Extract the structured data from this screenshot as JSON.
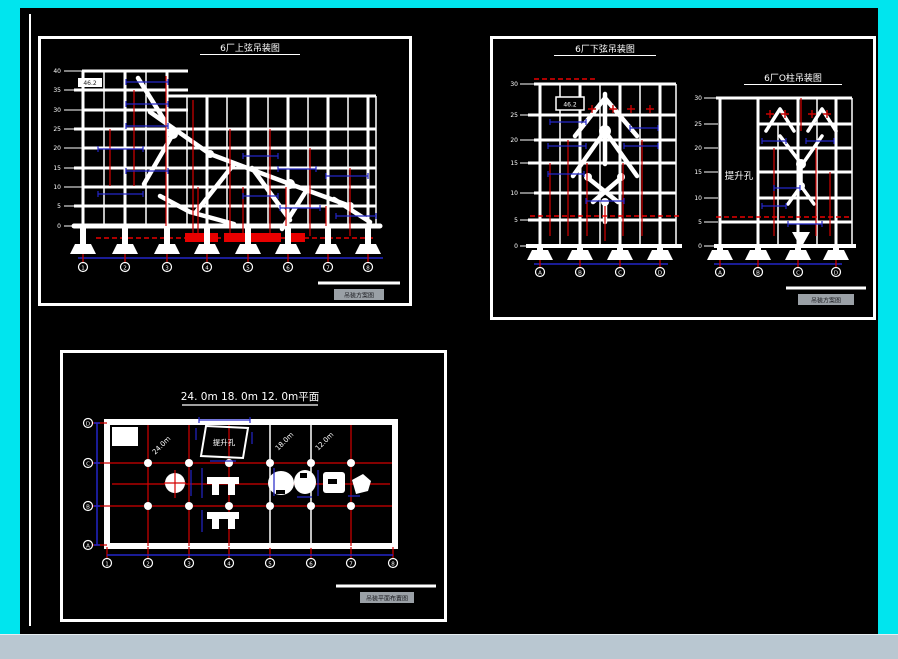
{
  "colors": {
    "window_frame": "#00e5ee",
    "canvas_background": "#000000",
    "drawing_lines": "#ffffff",
    "dimension_red": "#d40000",
    "highlight_red_fill": "#e80000",
    "dimension_blue": "#2326c8",
    "bottom_bar": "#b9c7d1",
    "titleblock_chip": "#9aa0a6"
  },
  "drawing1": {
    "title": "6厂上弦吊装图",
    "note": "46.2",
    "elevation_labels": [
      "40",
      "35",
      "30",
      "25",
      "20",
      "15",
      "10",
      "5",
      "0"
    ],
    "grid_bubbles": [
      "1",
      "2",
      "3",
      "4",
      "5",
      "6",
      "7",
      "8"
    ],
    "titleblock": "吊装方案图"
  },
  "drawing2": {
    "left": {
      "title": "6厂下弦吊装图",
      "note": "46.2",
      "elevation_labels": [
        "30",
        "25",
        "20",
        "15",
        "10",
        "5",
        "0"
      ],
      "grid_bubbles": [
        "A",
        "B",
        "C",
        "D"
      ]
    },
    "right": {
      "title": "6厂O柱吊装图",
      "lift_hole_label": "提升孔",
      "elevation_labels": [
        "30",
        "25",
        "20",
        "15",
        "10",
        "5",
        "0"
      ],
      "grid_bubbles": [
        "A",
        "B",
        "C",
        "D"
      ]
    },
    "titleblock": "吊装方案图"
  },
  "drawing3": {
    "title": "24. 0m 18. 0m 12. 0m平面",
    "lift_hole_label": "提升孔",
    "span_labels": [
      "24.0m",
      "18.0m",
      "12.0m"
    ],
    "row_bubbles": [
      "D",
      "C",
      "B",
      "A"
    ],
    "col_bubbles": [
      "1",
      "2",
      "3",
      "4",
      "5",
      "6",
      "7",
      "8"
    ],
    "titleblock": "吊装平面布置图"
  }
}
